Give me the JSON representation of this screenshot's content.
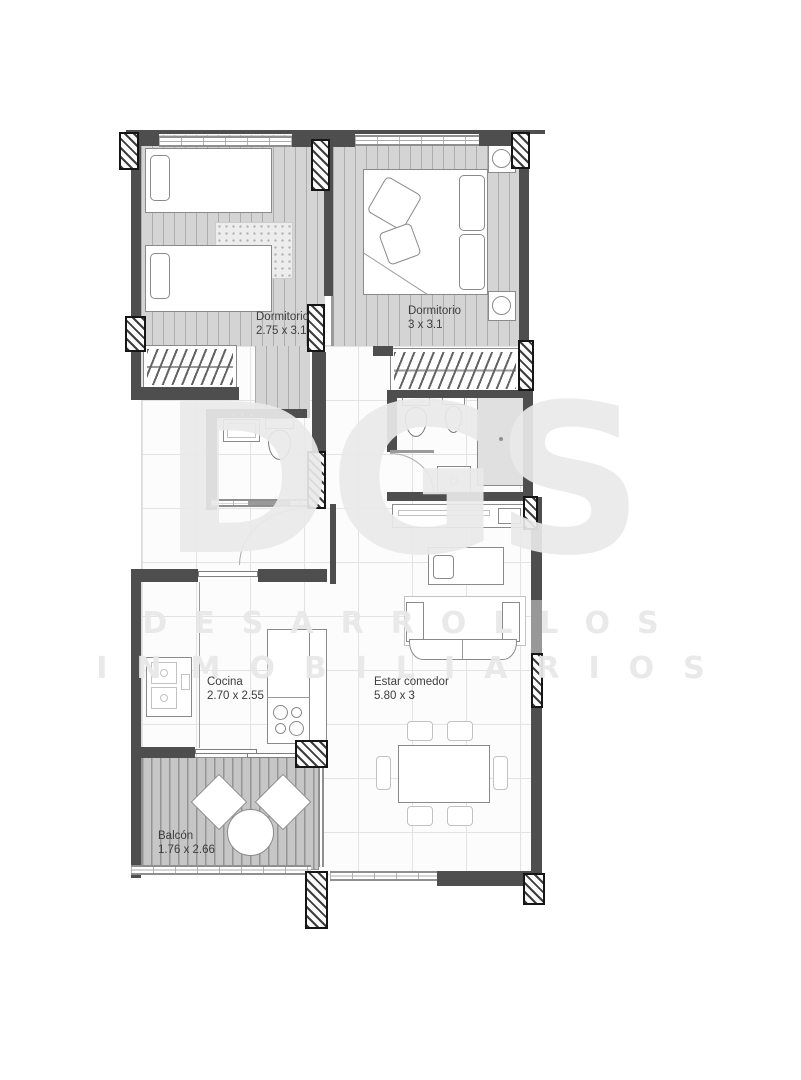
{
  "watermark": {
    "logo": "DGS",
    "line1": "DESARROLLOS",
    "line2": "INMOBILIARIOS"
  },
  "rooms": [
    {
      "name": "bedroom-1",
      "label": "Dormitorio",
      "dims": "2.75 x 3.1"
    },
    {
      "name": "bedroom-2",
      "label": "Dormitorio",
      "dims": "3 x 3.1"
    },
    {
      "name": "kitchen",
      "label": "Cocina",
      "dims": "2.70 x 2.55"
    },
    {
      "name": "living-dining",
      "label": "Estar comedor",
      "dims": "5.80 x 3"
    },
    {
      "name": "balcony",
      "label": "Balcón",
      "dims": "1.76 x 2.66"
    }
  ],
  "colors": {
    "wall": "#4e4e4e",
    "plank_floor": "#d4d4d4",
    "deck_floor": "#c6c6c6",
    "tile_line": "#e3e3e3",
    "watermark": "#ececec",
    "label_text": "#3d3d3d"
  }
}
